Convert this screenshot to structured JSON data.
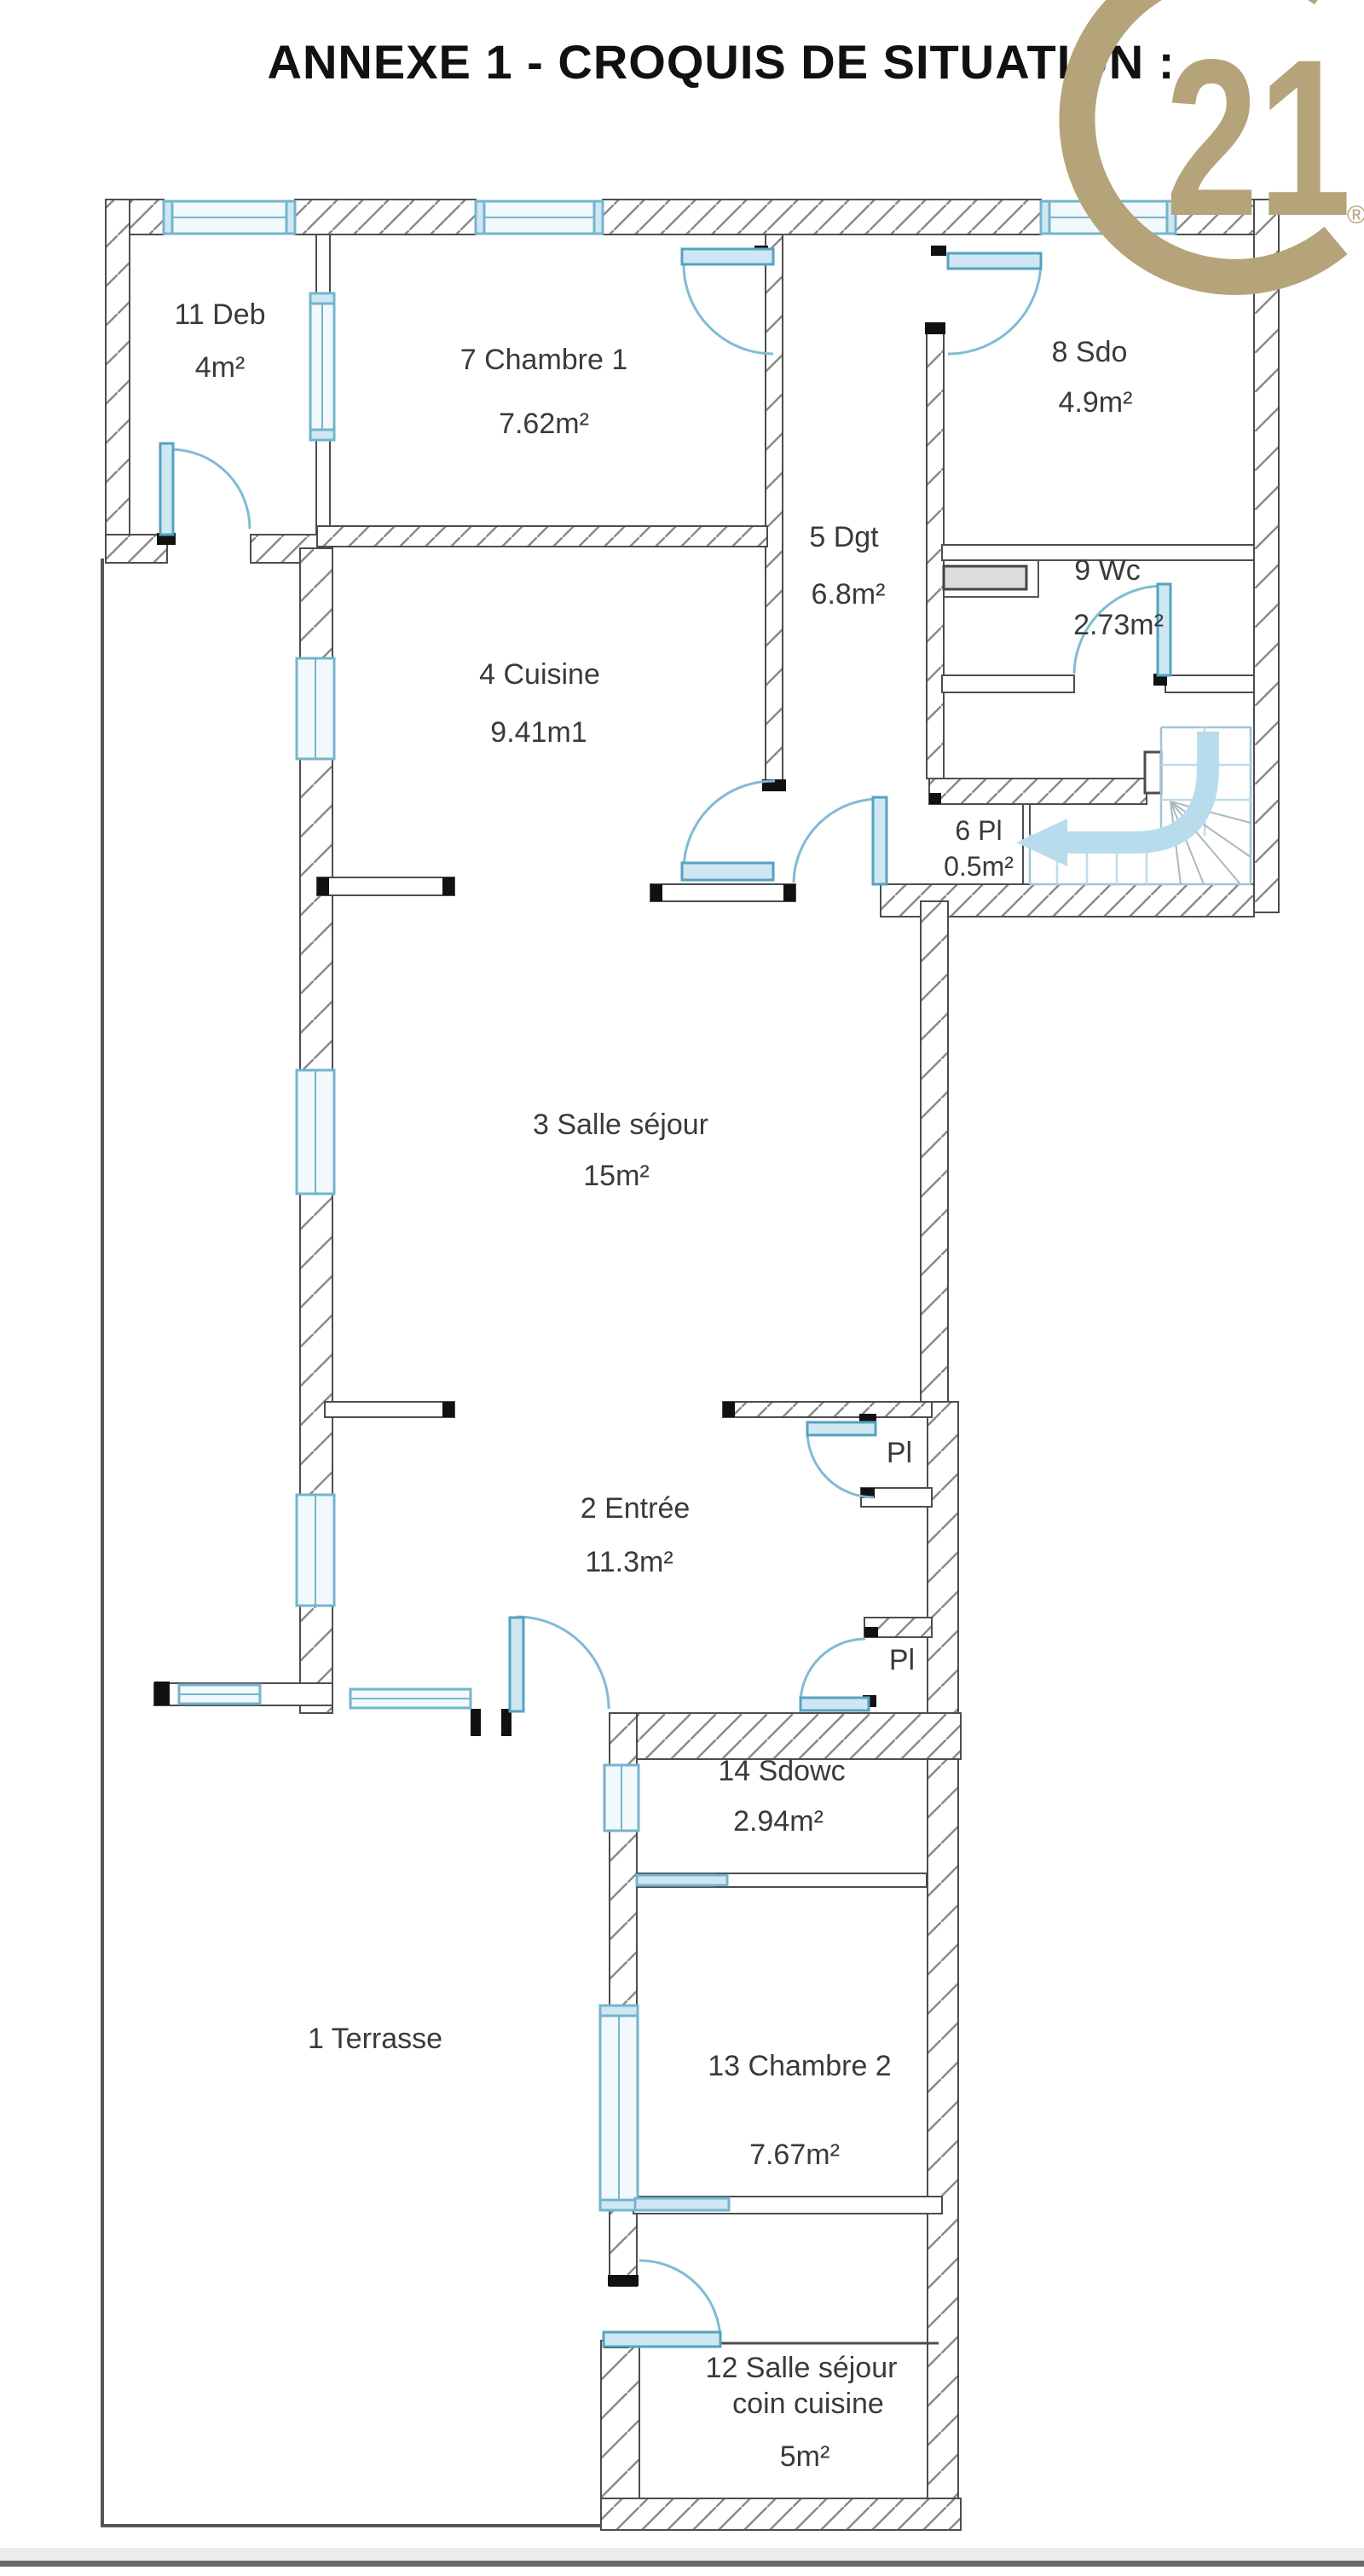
{
  "page": {
    "title": "ANNEXE 1 - CROQUIS DE SITUATION :"
  },
  "logo": {
    "number": "21",
    "registered": "®",
    "color": "#b5a479"
  },
  "rooms": {
    "terrasse": {
      "label": "1 Terrasse"
    },
    "entree": {
      "name": "2 Entrée",
      "area": "11.3m²"
    },
    "sejour": {
      "name": "3 Salle séjour",
      "area": "15m²"
    },
    "cuisine": {
      "name": "4 Cuisine",
      "area": "9.41m1"
    },
    "dgt": {
      "name": "5 Dgt",
      "area": "6.8m²"
    },
    "pl6": {
      "name": "6 Pl",
      "area": "0.5m²"
    },
    "chambre1": {
      "name": "7 Chambre 1",
      "area": "7.62m²"
    },
    "sdo": {
      "name": "8 Sdo",
      "area": "4.9m²"
    },
    "wc": {
      "name": "9 Wc",
      "area": "2.73m²"
    },
    "deb": {
      "name": "11 Deb",
      "area": "4m²"
    },
    "salle12": {
      "name": "12 Salle séjour",
      "name2": "coin cuisine",
      "area": "5m²"
    },
    "chambre2": {
      "name": "13 Chambre 2",
      "area": "7.67m²"
    },
    "sdowc": {
      "name": "14 Sdowc",
      "area": "2.94m²"
    },
    "pl_upper": {
      "label": "Pl"
    },
    "pl_lower": {
      "label": "Pl"
    }
  },
  "colors": {
    "wall_line": "#4d4d4d",
    "hatch": "#8a8a8a",
    "window_blue": "#74b4cd",
    "door_fill": "#cfe7f2",
    "stairs_blue": "#b8dcec",
    "logo_gold": "#b5a479",
    "label_text": "#3a3a3a"
  }
}
